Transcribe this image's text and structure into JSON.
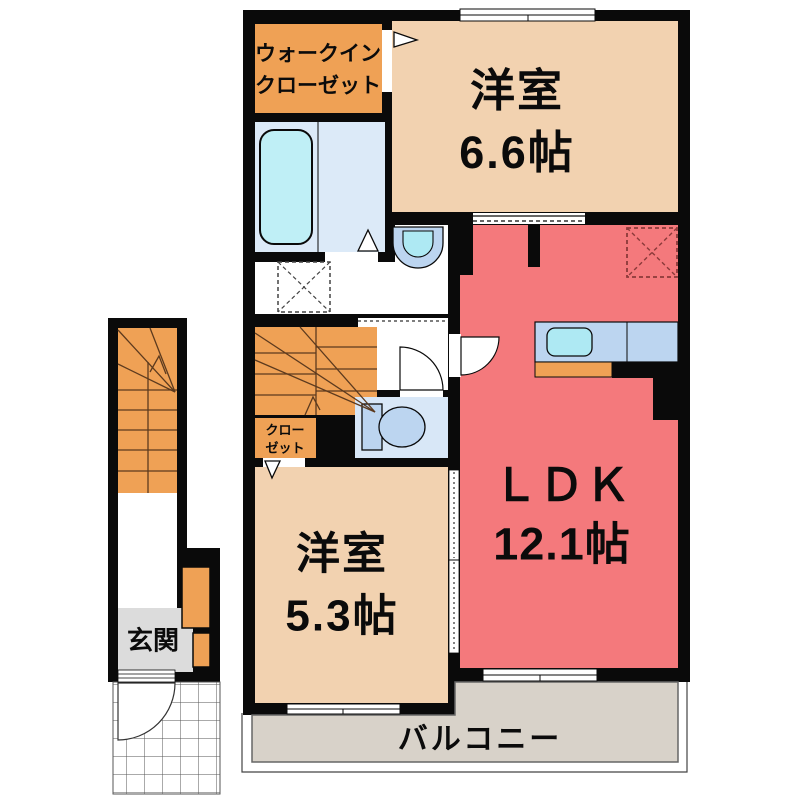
{
  "plan": {
    "title": "apartment-floor-plan",
    "rooms": {
      "walk_in_closet": "ウォークイン\nクローゼット",
      "bedroom1": "洋室\n6.6帖",
      "ldk": "ＬＤＫ\n12.1帖",
      "bedroom2": "洋室\n5.3帖",
      "closet": "クロー\nゼット",
      "entrance": "玄関",
      "balcony": "バルコニー"
    },
    "fixtures": [
      "bathtub",
      "bath-room",
      "wash-basin",
      "washing-machine-space",
      "toilet",
      "kitchen-counter",
      "kitchen-sink",
      "range-space",
      "staircase-exterior",
      "staircase-interior",
      "shoe-cabinet",
      "entrance-porch-tiles",
      "doors-and-windows"
    ],
    "colors": {
      "wall": "#0a0a0a",
      "orange": "#efa155",
      "beige": "#f2d2b0",
      "red": "#f4797c",
      "bathblue": "#dceaf8",
      "tub": "#bfeff6",
      "fixture": "#bcd5f0",
      "sink": "#aee9f3",
      "toiletroom": "#d8e7f7",
      "grey": "#dcdcdc",
      "balcony": "#d8d2c9",
      "stairline": "#5c3a1e",
      "dashred": "#8b3a3a"
    }
  }
}
